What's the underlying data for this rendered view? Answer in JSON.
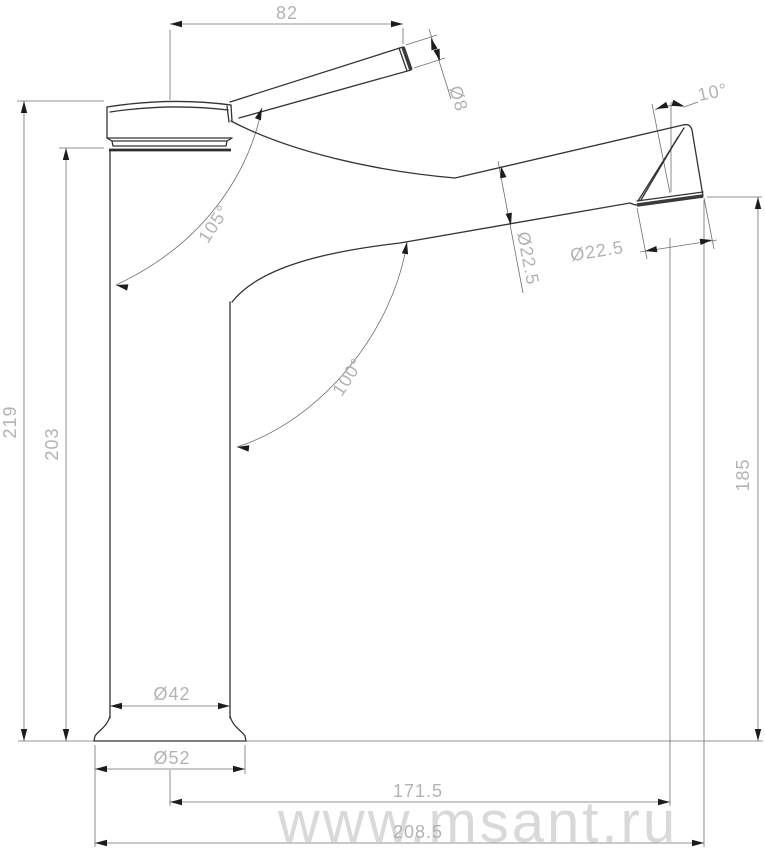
{
  "drawing": {
    "watermark": "www.msant.ru",
    "dimensions": {
      "handle_reach": "82",
      "handle_diameter": "Ø8",
      "spout_tip_angle": "10°",
      "handle_body_angle": "105°",
      "spout_body_angle": "100°",
      "spout_diameter": "Ø22.5",
      "outlet_diameter": "Ø22.5",
      "total_height": "219",
      "body_height": "203",
      "outlet_height": "185",
      "body_diameter": "Ø42",
      "base_diameter": "Ø52",
      "outlet_reach": "171.5",
      "total_reach": "208.5"
    }
  }
}
